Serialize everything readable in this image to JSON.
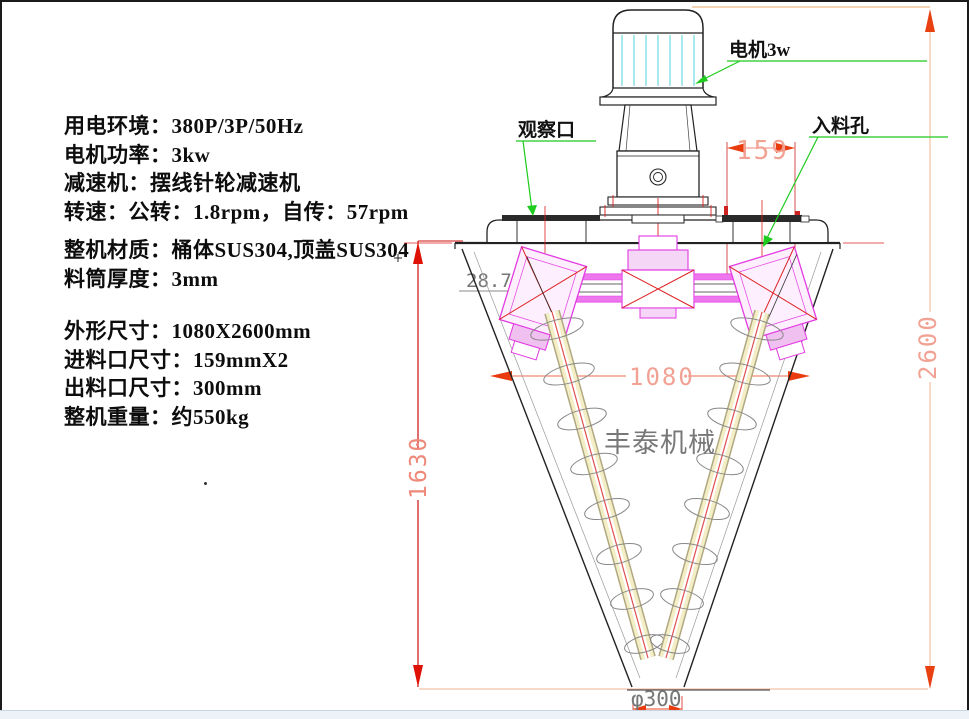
{
  "specs": {
    "block1": [
      "用电环境：380P/3P/50Hz",
      "电机功率：3kw",
      "减速机：摆线针轮减速机",
      "转速：公转：1.8rpm，自传：57rpm"
    ],
    "block2": [
      "整机材质：桶体SUS304,顶盖SUS304",
      "料筒厚度：3mm"
    ],
    "block3": [
      "外形尺寸：1080X2600mm",
      "进料口尺寸：159mmX2",
      "出料口尺寸：300mm",
      "整机重量：约550kg"
    ]
  },
  "callouts": {
    "motor": "电机3w",
    "observation_port": "观察口",
    "inlet_port": "入料孔"
  },
  "dimensions": {
    "inlet_width": "159",
    "overall_height": "2600",
    "body_diameter": "1080",
    "cone_height": "1630",
    "cone_angle": "28.74",
    "outlet_diameter": "φ300"
  },
  "watermark": "丰泰机械",
  "colors": {
    "dim_text_salmon": "#f2a294",
    "dim_line_red": "#cc1111",
    "arrow_red": "#e83c10",
    "leader_green": "#1ecb1e",
    "mechanism_magenta": "#e23ae2",
    "motor_fin_cyan": "#6fd8e0"
  }
}
